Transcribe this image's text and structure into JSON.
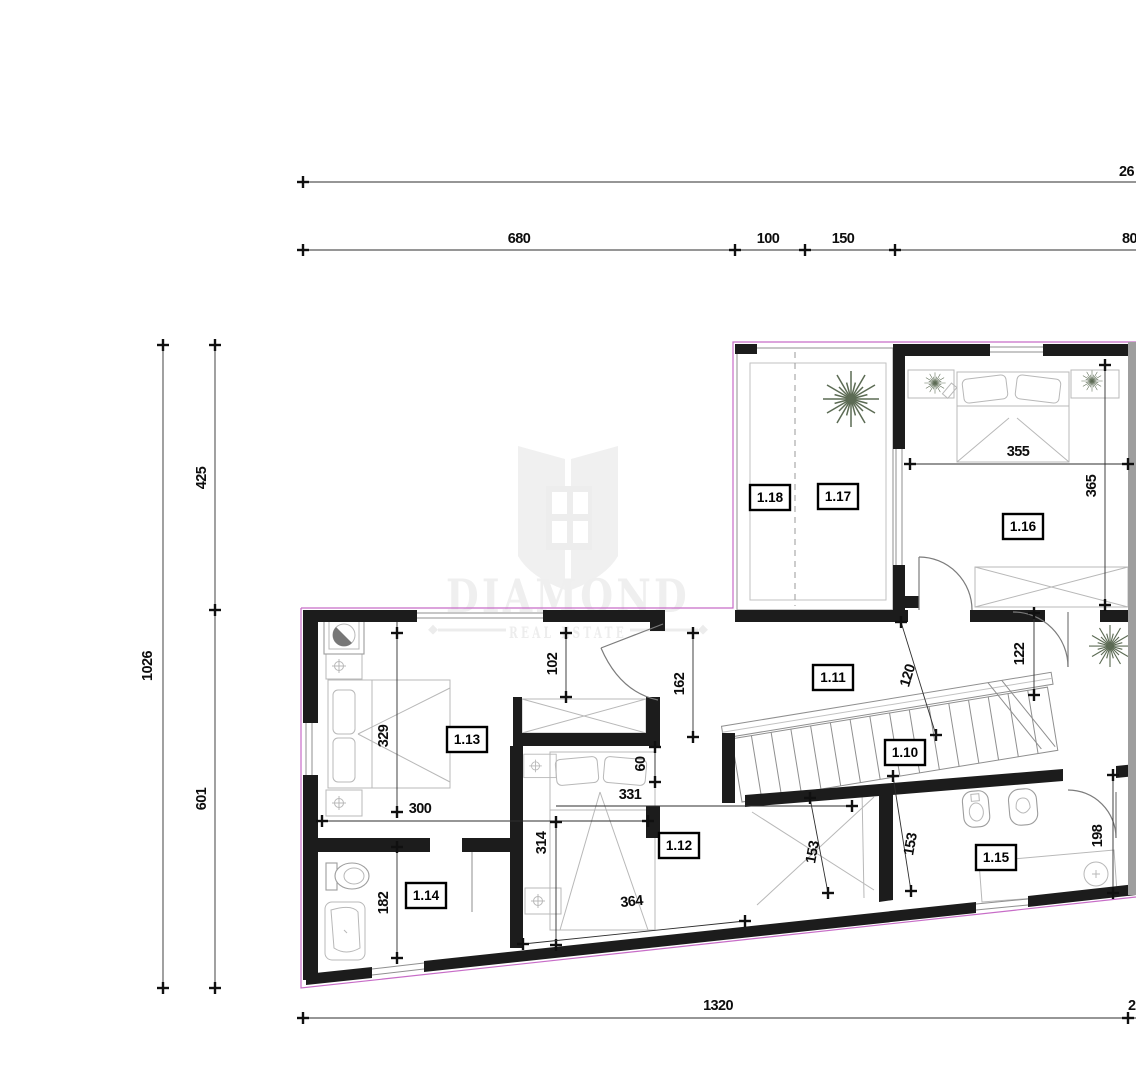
{
  "watermark": {
    "brand": "DIAMOND",
    "subtitle": "REAL ESTATE"
  },
  "rooms": {
    "r110": "1.10",
    "r111": "1.11",
    "r112": "1.12",
    "r113": "1.13",
    "r114": "1.14",
    "r115": "1.15",
    "r116": "1.16",
    "r117": "1.17",
    "r118": "1.18"
  },
  "dims": {
    "overall_top": "26",
    "top": {
      "d680": "680",
      "d100": "100",
      "d150": "150",
      "d80": "80"
    },
    "left": {
      "d1026": "1026",
      "d425": "425",
      "d601": "601"
    },
    "bottom": {
      "d1320": "1320",
      "d2": "2"
    },
    "interior": {
      "d355": "355",
      "d365": "365",
      "d102": "102",
      "d162": "162",
      "d120": "120",
      "d122": "122",
      "d329": "329",
      "d300": "300",
      "d331": "331",
      "d60": "60",
      "d314": "314",
      "d364": "364",
      "d153a": "153",
      "d153b": "153",
      "d198": "198",
      "d182": "182"
    }
  },
  "colors": {
    "wall": "#1c1c1c",
    "outline_magenta": "#c76cc7",
    "watermark": "#f0f0f0",
    "furniture": "#9d9d9d",
    "plant": "#5c6b54",
    "dimension": "#101010",
    "cut_edge": "#9e9e9e"
  }
}
